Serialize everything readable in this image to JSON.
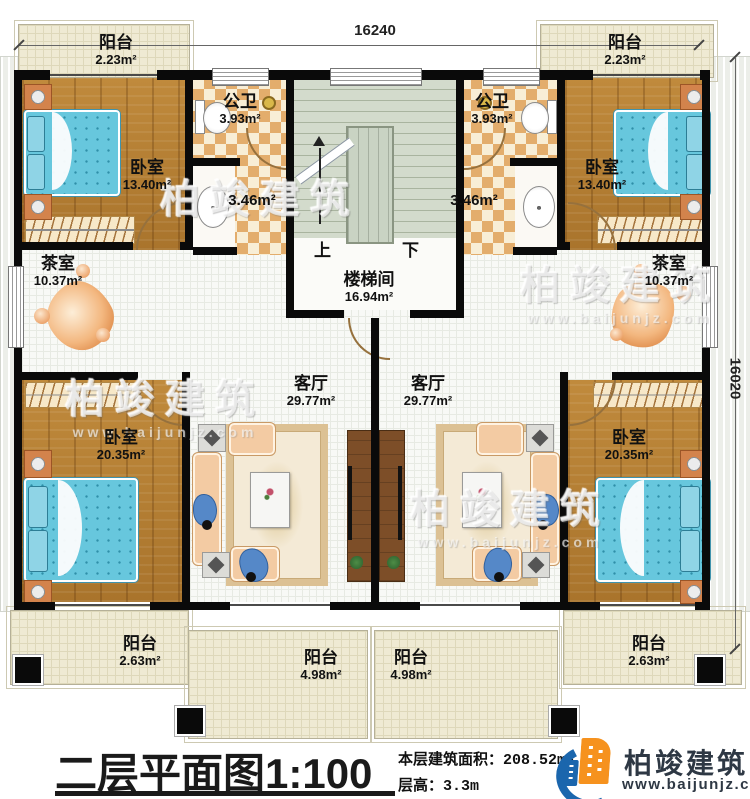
{
  "dimensions": {
    "width_top": "16240",
    "height_right": "16020"
  },
  "rooms": {
    "balcony_top_left": {
      "name": "阳台",
      "area": "2.23m²"
    },
    "balcony_top_right": {
      "name": "阳台",
      "area": "2.23m²"
    },
    "bedroom_top_left": {
      "name": "卧室",
      "area": "13.40m²"
    },
    "bedroom_top_right": {
      "name": "卧室",
      "area": "13.40m²"
    },
    "bath_left": {
      "name": "公卫",
      "area": "3.93m²"
    },
    "bath_right": {
      "name": "公卫",
      "area": "3.93m²"
    },
    "vanity_left": {
      "area": "3.46m²"
    },
    "vanity_right": {
      "area": "3.46m²"
    },
    "stairwell": {
      "name": "楼梯间",
      "area": "16.94m²"
    },
    "tea_left": {
      "name": "茶室",
      "area": "10.37m²"
    },
    "tea_right": {
      "name": "茶室",
      "area": "10.37m²"
    },
    "living_left": {
      "name": "客厅",
      "area": "29.77m²"
    },
    "living_right": {
      "name": "客厅",
      "area": "29.77m²"
    },
    "bedroom_bottom_left": {
      "name": "卧室",
      "area": "20.35m²"
    },
    "bedroom_bottom_right": {
      "name": "卧室",
      "area": "20.35m²"
    },
    "balcony_bottom_left": {
      "name": "阳台",
      "area": "2.63m²"
    },
    "balcony_bottom_right": {
      "name": "阳台",
      "area": "2.63m²"
    },
    "balcony_bottom_center_left": {
      "name": "阳台",
      "area": "4.98m²"
    },
    "balcony_bottom_center_right": {
      "name": "阳台",
      "area": "4.98m²"
    }
  },
  "stairs": {
    "up": "上",
    "down": "下"
  },
  "footer": {
    "title": "二层平面图1:100",
    "floor_area_label": "本层建筑面积：",
    "floor_area_value": "208.52m²",
    "floor_height_label": "层高：",
    "floor_height_value": "3.3m"
  },
  "brand": {
    "name": "柏竣建筑",
    "url": "www.baijunjz.com"
  },
  "colors": {
    "accent_orange": "#f6921e",
    "accent_blue": "#1b66ad",
    "wall_black": "#0a0a0a",
    "checker_tan": "#e3ad6c",
    "wood_brown": "#b6813a",
    "bed_blue": "#67c7dd"
  }
}
